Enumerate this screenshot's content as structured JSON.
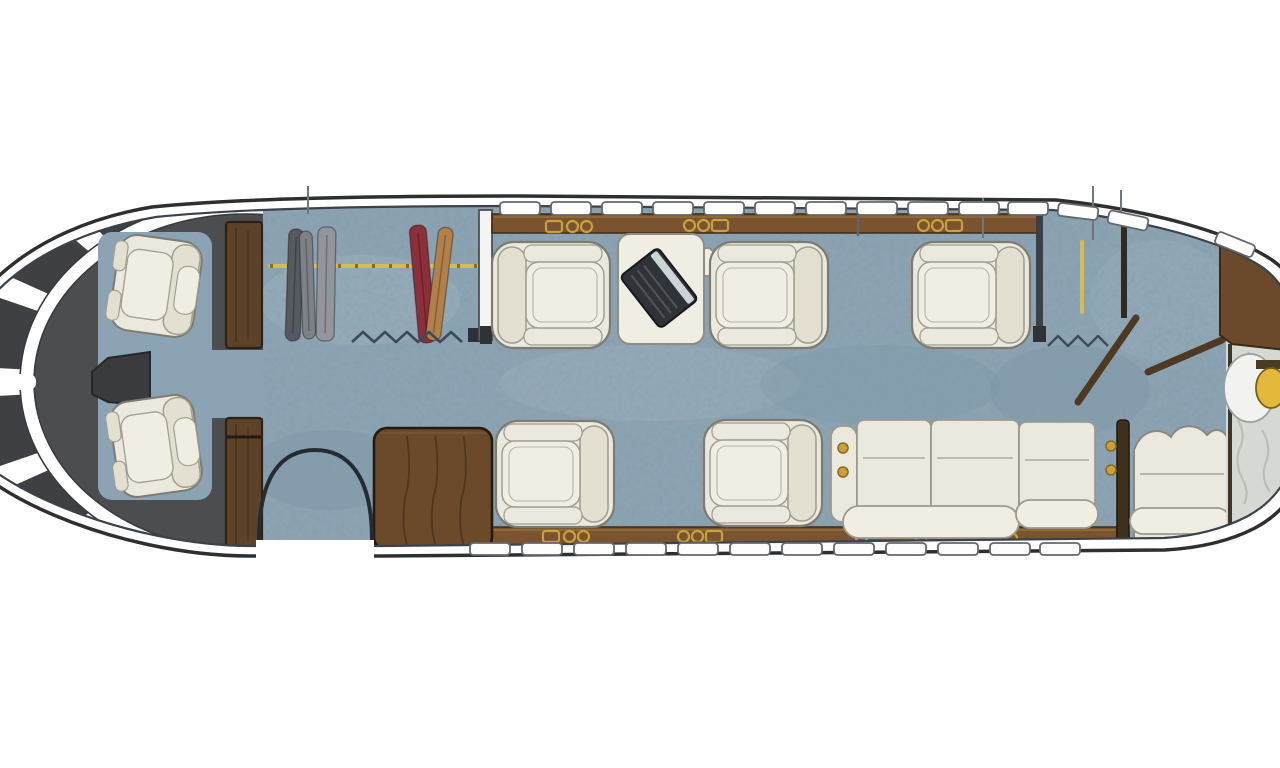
{
  "meta": {
    "kind": "aircraft-cabin-floor-plan"
  },
  "palette": {
    "hull_line": "#2d2f31",
    "trim": "#ffffff",
    "inner_line": "#3b4349",
    "carpet": "#8ba3b2",
    "carpet_dark": "#74909f",
    "carpet_light": "#a4b6c0",
    "cockpit": "#4c4d4f",
    "pane": "#3e4043",
    "console": "#3a3b3e",
    "wood_rail": "#7a5330",
    "wood_rail_line": "#463019",
    "wood_rail_hi": "#9a7240",
    "wood_cabinet": "#6b4a2c",
    "wood_dark": "#5d422a",
    "wood_line": "#2e2114",
    "door_wood": "#4e3a22",
    "seat_fill": "#ebe9dd",
    "seat_fill2": "#f0eee3",
    "seat_shade": "#e3e0d1",
    "seat_line": "#a19f92",
    "seat_edge": "#7e7c72",
    "divan_line": "#9c9a8d",
    "gold": "#c9a23c",
    "gold_dark": "#8a6b1f",
    "rod_gold": "#d9ba52",
    "white_wall": "#f4f4f2",
    "wall_edge": "#4a4f52",
    "marble": "#d6d9d3",
    "marble_vein": "#b3b9b2",
    "curtain": "#3d4a57",
    "garment_dark": "#565a60",
    "garment_mid": "#7d8187",
    "garment_light": "#92969c",
    "garment_red": "#8c2f3a",
    "garment_tan": "#b28049",
    "laptop": "#2f3237",
    "laptop_edge": "#17191c",
    "laptop_screen": "#ccd4d8",
    "laptop_keys": "#50555b",
    "tick": "#6f777d",
    "window_fill": "#fdfdfc",
    "window_edge": "#63686c",
    "sink_gold": "#e3b93c",
    "sink_gold_edge": "#7c5d14"
  },
  "fuselage": {
    "outer_path": "M -60 390 C -52 302 26 228 152 207 C 240 198 380 196 520 196 L 1056 200 C 1150 210 1230 232 1272 260 C 1295 276 1306 300 1308 330 L 1308 450 C 1304 485 1285 512 1255 528 C 1230 541 1200 548 1165 550 L 380 556 L 250 556 C 120 556 -40 492 -60 420 Z",
    "inner_path": "M -50 390 C -43 306 32 238 156 217 C 244 208 382 206 522 206 L 1052 210 C 1142 219 1220 240 1262 267 C 1283 282 1294 304 1296 332 L 1296 446 C 1292 477 1275 501 1248 516 C 1225 528 1196 536 1164 538 L 380 546 L 252 546 C 128 546 -32 484 -50 418 Z"
  },
  "cockpit": {
    "zone_max_x": 263,
    "center": [
      245,
      382
    ],
    "band": {
      "rx": 218,
      "ry": 175,
      "width": 14
    },
    "core": {
      "rx": 212,
      "ry": 170
    },
    "pane": {
      "rx": 224,
      "ry": 181,
      "s1": 0.95,
      "s2": 1.38
    },
    "pane_angles": [
      [
        112,
        128
      ],
      [
        134,
        151
      ],
      [
        157,
        176
      ],
      [
        184,
        203
      ],
      [
        209,
        226
      ],
      [
        232,
        248
      ]
    ],
    "spoke": {
      "x": -60,
      "y": 374,
      "w": 96,
      "h": 16
    },
    "floor_patches": [
      {
        "x": 98,
        "y": 232,
        "w": 114,
        "h": 268,
        "rx": 14
      },
      {
        "x": 205,
        "y": 350,
        "w": 60,
        "h": 68,
        "rx": 2
      }
    ],
    "console": "M150,352 L108,358 L92,372 L92,394 L108,402 L150,406 Z",
    "crew_seats": [
      {
        "x": 110,
        "y": 238,
        "rot": 8
      },
      {
        "x": 110,
        "y": 398,
        "rot": -8
      }
    ]
  },
  "pillars": [
    {
      "x": 226,
      "y": 222,
      "w": 36,
      "h": 126,
      "band_y": null
    },
    {
      "x": 226,
      "y": 418,
      "w": 36,
      "h": 132,
      "band_y": 437
    }
  ],
  "forward_closet": {
    "rod": {
      "x1": 270,
      "y1": 266,
      "x2": 478,
      "y2": 266
    },
    "garments": [
      {
        "x": 287,
        "y": 229,
        "w": 15,
        "h": 112,
        "rot": 2,
        "color": "garment_dark"
      },
      {
        "x": 301,
        "y": 231,
        "w": 13,
        "h": 108,
        "rot": -2,
        "color": "garment_mid"
      },
      {
        "x": 317,
        "y": 227,
        "w": 18,
        "h": 114,
        "rot": 1,
        "color": "garment_light"
      },
      {
        "x": 414,
        "y": 225,
        "w": 17,
        "h": 118,
        "rot": -5,
        "color": "garment_red"
      },
      {
        "x": 432,
        "y": 227,
        "w": 15,
        "h": 114,
        "rot": 7,
        "color": "garment_tan"
      }
    ],
    "curtain": {
      "x1": 352,
      "x2": 468,
      "y": 337,
      "step": 11,
      "amp": 5
    },
    "curtain_foot": {
      "x": 468,
      "y": 328,
      "w": 16,
      "h": 14
    },
    "wall": {
      "x": 479,
      "y": 210,
      "w": 13,
      "h": 130
    },
    "wall_foot": {
      "x": 480,
      "y": 326,
      "w": 12,
      "h": 18
    }
  },
  "rails": {
    "top": {
      "x": 492,
      "y": 214,
      "w": 546,
      "h": 19
    },
    "bottom": {
      "x": 374,
      "y": 527,
      "w": 743,
      "h": 19
    }
  },
  "cupholders": [
    {
      "x": 546,
      "y": 221,
      "items": [
        "slot",
        "cup",
        "cup"
      ]
    },
    {
      "x": 684,
      "y": 220,
      "items": [
        "cup",
        "cup",
        "slot"
      ]
    },
    {
      "x": 918,
      "y": 220,
      "items": [
        "cup",
        "cup",
        "slot"
      ]
    },
    {
      "x": 543,
      "y": 531,
      "items": [
        "slot",
        "cup",
        "cup"
      ]
    },
    {
      "x": 678,
      "y": 531,
      "items": [
        "cup",
        "cup",
        "slot"
      ]
    },
    {
      "x": 856,
      "y": 532,
      "items": [
        "cup"
      ]
    },
    {
      "x": 916,
      "y": 532,
      "items": [
        "cup"
      ]
    },
    {
      "x": 1006,
      "y": 533,
      "items": [
        "cup"
      ]
    }
  ],
  "seats": [
    {
      "x": 492,
      "y": 242,
      "flip": true
    },
    {
      "x": 710,
      "y": 242,
      "flip": false
    },
    {
      "x": 912,
      "y": 242,
      "flip": false
    },
    {
      "x": 496,
      "y": 421,
      "flip": false
    },
    {
      "x": 704,
      "y": 420,
      "flip": false
    }
  ],
  "seat_size": {
    "w": 118,
    "h": 106
  },
  "table": {
    "x": 618,
    "y": 234,
    "w": 86,
    "h": 110,
    "ear": {
      "cx": 707,
      "cy": 262,
      "rx": 9,
      "ry": 14
    }
  },
  "laptop": {
    "cx": 659,
    "cy": 288,
    "rot": -38,
    "w": 48,
    "h": 66
  },
  "credenza": {
    "x": 374,
    "y": 428,
    "w": 118,
    "h": 122
  },
  "entry_door": {
    "gap": {
      "x": 256,
      "y": 540,
      "w": 118,
      "h": 36
    },
    "arc": "M 259 540 C 259 474 283 450 315 450 C 347 450 372 474 372 540"
  },
  "divan": {
    "arm": {
      "x": 831,
      "y": 426,
      "w": 26,
      "h": 96
    },
    "cushions": [
      {
        "x": 857,
        "y": 420,
        "w": 74,
        "h": 92
      },
      {
        "x": 931,
        "y": 420,
        "w": 88,
        "h": 92
      },
      {
        "x": 1019,
        "y": 422,
        "w": 76,
        "h": 86
      }
    ],
    "seam_dy": 38,
    "bolster": {
      "x": 843,
      "y": 506,
      "w": 176,
      "h": 32
    },
    "bolster2": {
      "x": 1016,
      "y": 500,
      "w": 82,
      "h": 28
    },
    "arm_dots": [
      [
        843,
        448
      ],
      [
        843,
        472
      ]
    ]
  },
  "aft_partition": {
    "x": 1117,
    "y": 420,
    "w": 12,
    "h": 126,
    "dots": [
      [
        1111,
        446
      ],
      [
        1111,
        470
      ]
    ]
  },
  "bench": {
    "path": "M 1134 450 C 1141 430 1159 426 1171 437 C 1177 424 1197 422 1207 435 C 1215 427 1224 429 1228 439 L 1228 540 L 1134 540 Z",
    "seam_y": 474,
    "pill": {
      "x": 1130,
      "y": 508,
      "w": 100,
      "h": 26
    }
  },
  "aft_closet": {
    "wall1": {
      "x": 1036,
      "y": 212,
      "w": 7,
      "h": 128
    },
    "wall1_foot": {
      "x": 1033,
      "y": 326,
      "w": 13,
      "h": 16
    },
    "rod": {
      "x1": 1082,
      "y1": 242,
      "x2": 1082,
      "y2": 312
    },
    "curtain": {
      "x1": 1048,
      "x2": 1116,
      "y": 341,
      "step": 10,
      "amp": 5
    },
    "wall2": {
      "x": 1121,
      "y": 214,
      "w": 6,
      "h": 104
    },
    "doors": [
      {
        "x1": 1136,
        "y1": 318,
        "x2": 1078,
        "y2": 402
      },
      {
        "x1": 1148,
        "y1": 372,
        "x2": 1222,
        "y2": 340
      }
    ]
  },
  "aft_cabinet": "M 1220 241 C 1241 247 1258 257 1271 269 C 1285 282 1292 301 1294 325 L 1294 351 L 1232 344 L 1220 335 Z",
  "lavatory": {
    "marble": {
      "x": 1226,
      "y": 296,
      "w": 92,
      "h": 250
    },
    "boundary": {
      "x": 1230,
      "y1": 344,
      "y2": 538
    },
    "veins": [
      "M 1238 420 q 8 14 2 28 q -6 14 2 30 q 8 14 2 26",
      "M 1262 430 q 10 16 4 32 q -6 16 4 30",
      "M 1248 352 q 10 12 4 26 q -6 14 4 26"
    ],
    "sink": {
      "oval": {
        "cx": 1250,
        "cy": 388,
        "rx": 26,
        "ry": 34
      },
      "gold": {
        "cx": 1271,
        "cy": 388,
        "rx": 15,
        "ry": 20
      },
      "bar": {
        "x": 1256,
        "y": 360,
        "w": 34,
        "h": 9
      }
    }
  },
  "windows": {
    "w": 40,
    "h": 13,
    "top_y": 202,
    "bottom_y": 543,
    "bottom_h": 12,
    "top_x": [
      500,
      551,
      602,
      653,
      704,
      755,
      806,
      857,
      908,
      959,
      1008
    ],
    "slanted": [
      {
        "x": 1058,
        "y": 205,
        "r": 7
      },
      {
        "x": 1108,
        "y": 214,
        "r": 12
      },
      {
        "x": 1215,
        "y": 238,
        "r": 22
      }
    ],
    "bottom_x": [
      470,
      522,
      574,
      626,
      678,
      730,
      782,
      834,
      886,
      938,
      990,
      1040
    ]
  },
  "ticks": [
    {
      "x": 308,
      "y1": 186,
      "y2": 214
    },
    {
      "x": 983,
      "y1": 198,
      "y2": 238
    },
    {
      "x": 1093,
      "y1": 186,
      "y2": 240
    },
    {
      "x": 1121,
      "y1": 190,
      "y2": 218
    }
  ],
  "mid_tick": {
    "x": 858,
    "y1": 214,
    "y2": 236
  },
  "mottle": [
    {
      "cx": 360,
      "cy": 300,
      "rx": 100,
      "ry": 45,
      "c": "carpet_light",
      "o": 0.35
    },
    {
      "cx": 330,
      "cy": 470,
      "rx": 80,
      "ry": 40,
      "c": "carpet_dark",
      "o": 0.28
    },
    {
      "cx": 650,
      "cy": 383,
      "rx": 150,
      "ry": 38,
      "c": "carpet_light",
      "o": 0.3
    },
    {
      "cx": 880,
      "cy": 385,
      "rx": 120,
      "ry": 40,
      "c": "carpet_dark",
      "o": 0.22
    },
    {
      "cx": 1070,
      "cy": 390,
      "rx": 80,
      "ry": 45,
      "c": "carpet_dark",
      "o": 0.28
    },
    {
      "cx": 1160,
      "cy": 300,
      "rx": 70,
      "ry": 60,
      "c": "carpet_light",
      "o": 0.22
    }
  ]
}
